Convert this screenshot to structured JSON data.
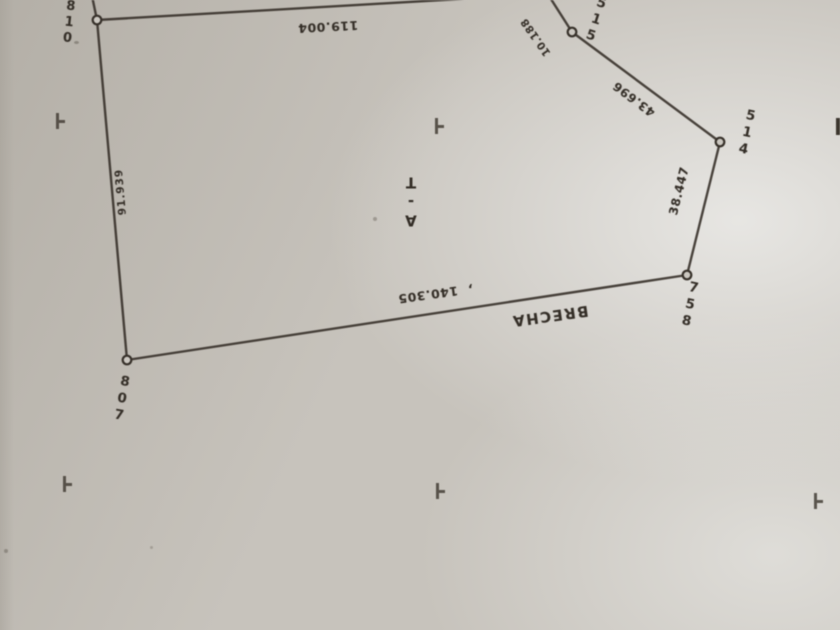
{
  "colors": {
    "paper": "#c7c3bc",
    "ink": "#37312a"
  },
  "survey_plat": {
    "orientation_note": "scan rotated 180 degrees",
    "parcel_label": "A-T",
    "road_label": "BRECHA",
    "points": {
      "p810": "810",
      "p515": "515",
      "p514": "514",
      "p758": "758",
      "p807": "807"
    },
    "distances": {
      "d_810_top": "119.004",
      "d_515_stub": "10.188",
      "d_515_514": "43.696",
      "d_514_758": "38.447",
      "d_758_807": "140.305",
      "d_807_810": "91.939"
    },
    "stray_mark": ","
  }
}
